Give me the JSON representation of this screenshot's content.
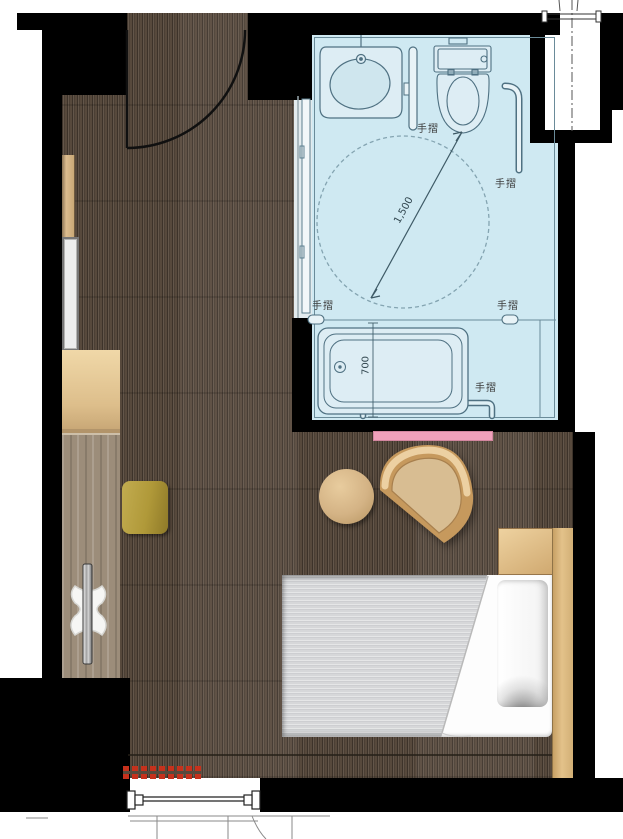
{
  "bath": {
    "rails": [
      "手摺",
      "手摺",
      "手摺",
      "手摺",
      "手摺"
    ],
    "dims": {
      "circle": "1,500",
      "tub": "700"
    }
  },
  "icons": {
    "turning_circle": "wheelchair-turning-circle",
    "door_swing": "door-swing-arc",
    "pipe_shaft": "pipe-shaft-centerline"
  },
  "colors": {
    "wall": "#000000",
    "carpet": "#57493c",
    "bathroom_fill": "#cfe9f2",
    "bathroom_line": "#4f7182",
    "wood_light": "#ddbb88",
    "counter": "#9c8d7a",
    "olive_stool": "#b3993f",
    "pink_accent": "#f0a1bb",
    "hatch_red": "#c6311c",
    "duvet_gray": "#d7d8da"
  }
}
